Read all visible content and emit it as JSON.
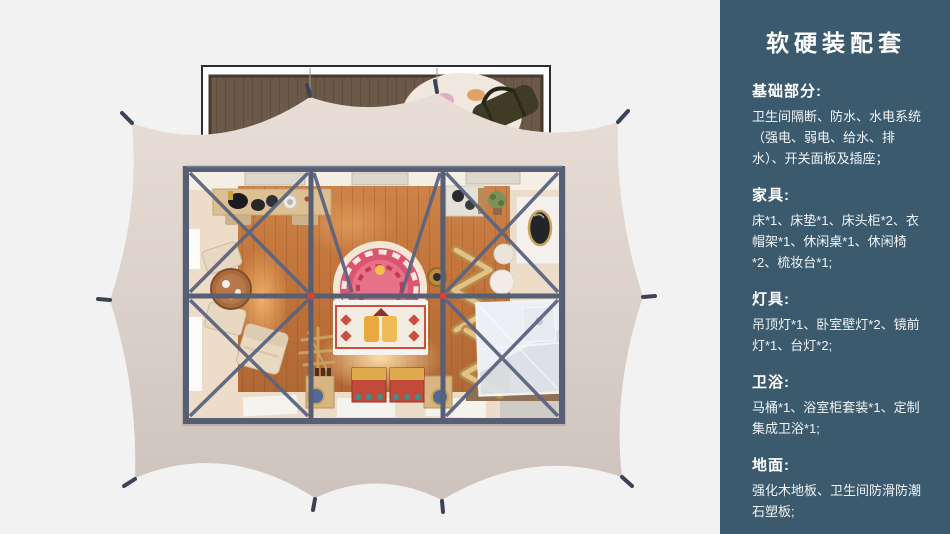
{
  "palette": {
    "background": "#f2f2f3",
    "sidebar_bg": "#3b5a6d",
    "sidebar_text": "#ffffff",
    "tent_canvas": "#ddd2ca",
    "steel_frame": "#565f74",
    "joint_marker_red": "#d6423e",
    "wood_floor": "#c0773f",
    "deck_wood": "#6d594a",
    "bed_accent_red": "#c8503f",
    "headboard_pink": "#db5570",
    "bathroom_unit": "#dde2e8"
  },
  "sidebar": {
    "title": "软硬装配套",
    "sections": [
      {
        "heading": "基础部分:",
        "body": "卫生间隔断、防水、水电系统（强电、弱电、给水、排水）、开关面板及插座；"
      },
      {
        "heading": "家具:",
        "body": "床*1、床垫*1、床头柜*2、衣帽架*1、休闲桌*1、休闲椅*2、梳妆台*1;"
      },
      {
        "heading": "灯具:",
        "body": "吊顶灯*1、卧室壁灯*2、镜前灯*1、台灯*2;"
      },
      {
        "heading": "卫浴:",
        "body": "马桶*1、浴室柜套装*1、定制集成卫浴*1;"
      },
      {
        "heading": "地面:",
        "body": "强化木地板、卫生间防滑防潮石塑板;"
      }
    ]
  },
  "illustration": {
    "type": "top-down-3d-floorplan-render",
    "objects": [
      "wood-deck",
      "area-rug",
      "duffel-bag",
      "tent-canvas",
      "tent-stakes",
      "steel-frame",
      "cross-braces",
      "wood-floor",
      "console-table",
      "hats",
      "round-tea-table",
      "cushion-chairs",
      "lounge-chair",
      "bed",
      "ornate-headboard-arch",
      "storage-chests",
      "nightstands",
      "clothes-rack",
      "zigzag-shelves",
      "vanity-with-mirror",
      "vanity-stool",
      "burner-table",
      "plant",
      "bathroom-pod",
      "floor-mats",
      "windows",
      "ceiling-vents"
    ]
  }
}
